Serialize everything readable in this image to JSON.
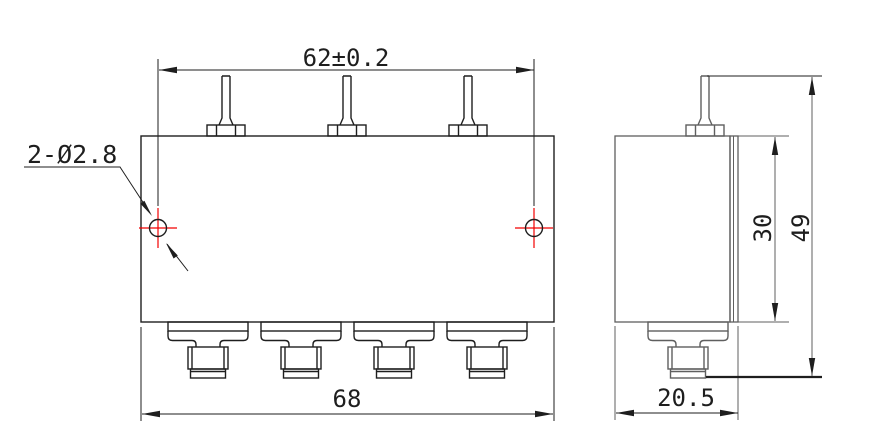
{
  "drawing": {
    "hole_callout": "2-Ø2.8",
    "dim_width_top": "62±0.2",
    "dim_width_bottom": "68",
    "dim_depth": "20.5",
    "dim_height_body": "30",
    "dim_height_total": "49"
  },
  "front_view": {
    "top_pin_count": 3,
    "bottom_connector_count": 4,
    "mounting_hole_count": 2
  },
  "side_view": {
    "top_pin_count": 1,
    "bottom_connector_count": 1
  },
  "colors": {
    "line": "#1e1e1e",
    "secondary_line": "#5f5f5f",
    "hole_marker": "#f20000",
    "background": "#ffffff"
  }
}
